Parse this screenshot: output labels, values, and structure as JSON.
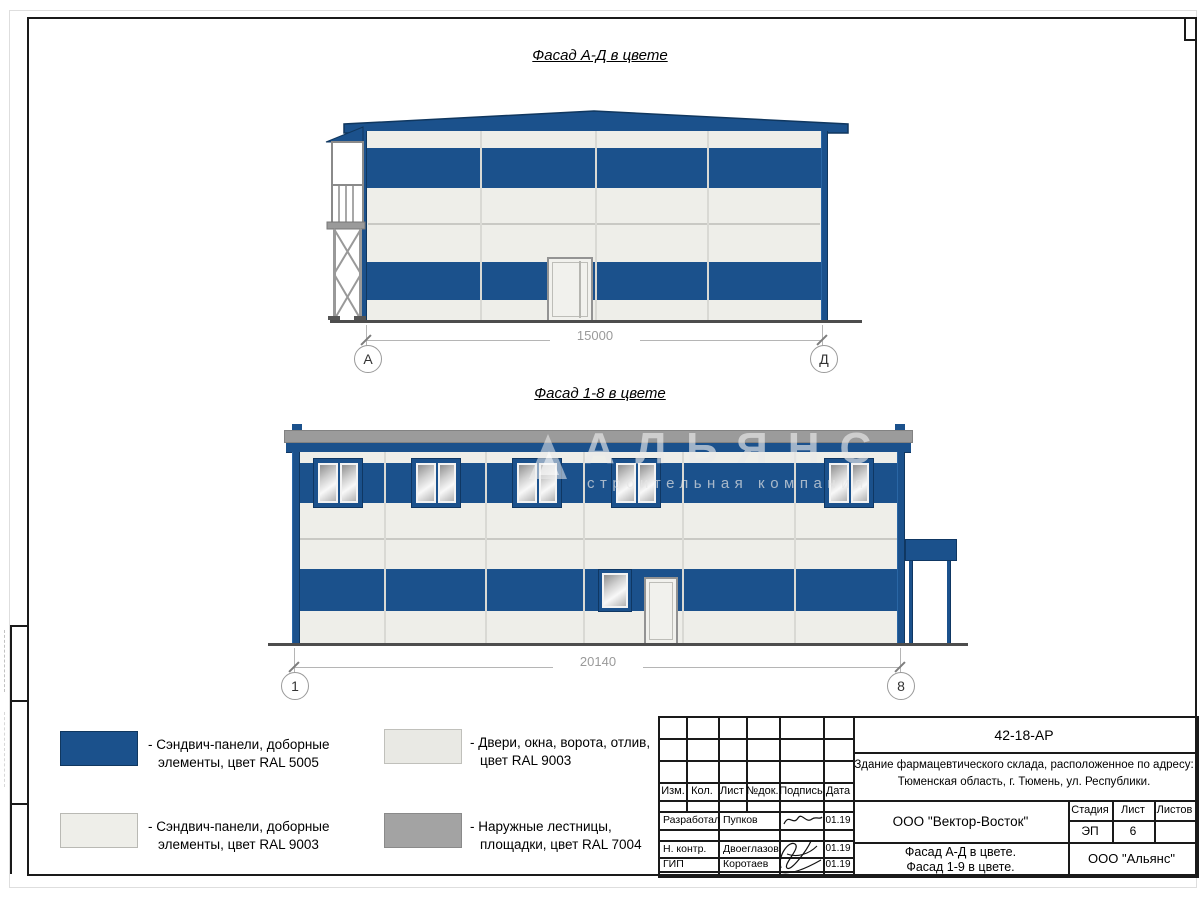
{
  "titles": {
    "facade_ad": "Фасад А-Д в цвете",
    "facade_18": "Фасад 1-8 в цвете"
  },
  "facade_ad": {
    "dimension": "15000",
    "axis_left": "А",
    "axis_right": "Д"
  },
  "facade_18": {
    "dimension": "20140",
    "axis_left": "1",
    "axis_right": "8"
  },
  "watermark": {
    "title": "АЛЬЯНС",
    "subtitle": "строительная компания"
  },
  "legend": {
    "items": [
      {
        "swatch_color": "#1b518c",
        "line1": "- Сэндвич-панели, доборные",
        "line2": "элементы, цвет RAL 5005"
      },
      {
        "swatch_color": "#eeeee9",
        "line1": "- Сэндвич-панели, доборные",
        "line2": "элементы, цвет RAL 9003"
      },
      {
        "swatch_color": "#e9e9e4",
        "line1": "- Двери, окна, ворота, отлив,",
        "line2": "цвет RAL 9003"
      },
      {
        "swatch_color": "#a3a3a3",
        "line1": "- Наружные лестницы,",
        "line2": "площадки, цвет RAL 7004"
      }
    ]
  },
  "title_block": {
    "doc_number": "42-18-АР",
    "project_line1": "Здание фармацевтического склада, расположенное по адресу:",
    "project_line2": "Тюменская область, г. Тюмень, ул. Республики.",
    "columns": {
      "izm": "Изм.",
      "kol": "Кол.",
      "list": "Лист",
      "ndok": "№док.",
      "podpis": "Подпись",
      "data": "Дата"
    },
    "rows": [
      {
        "role": "Разработал",
        "name": "Пупков",
        "date": "01.19"
      },
      {
        "role": "Н. контр.",
        "name": "Двоеглазов",
        "date": "01.19"
      },
      {
        "role": "ГИП",
        "name": "Коротаев",
        "date": "01.19"
      }
    ],
    "developer": "ООО \"Вектор-Восток\"",
    "sheet_title_line1": "Фасад А-Д в цвете.",
    "sheet_title_line2": "Фасад 1-9 в цвете.",
    "stage_label": "Стадия",
    "stage_value": "ЭП",
    "sheet_label": "Лист",
    "sheet_value": "6",
    "sheets_label": "Листов",
    "customer": "ООО \"Альянс\""
  },
  "colors": {
    "ral5005_blue": "#1b518c",
    "ral9003_white": "#eeeee9",
    "ral7004_gray": "#9b9b9b"
  }
}
